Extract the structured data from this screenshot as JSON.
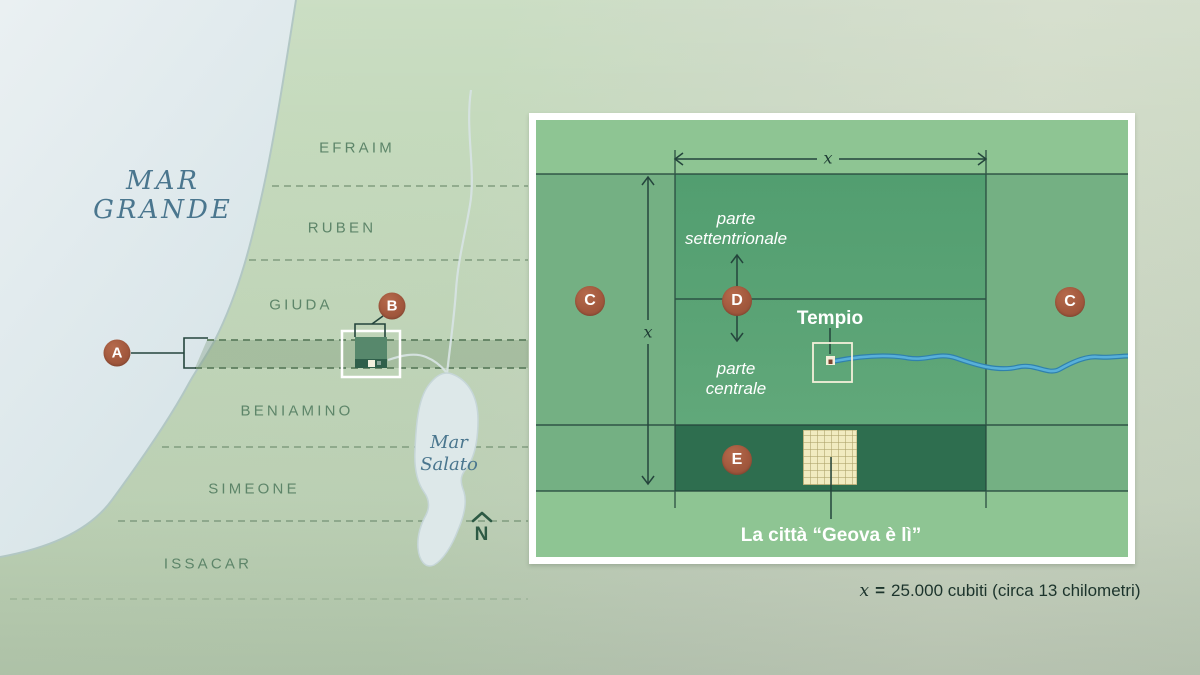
{
  "map": {
    "sea": {
      "line1": "MAR",
      "line2": "GRANDE"
    },
    "lake": {
      "line1": "Mar",
      "line2": "Salato"
    },
    "tribes": [
      {
        "label": "EFRAIM"
      },
      {
        "label": "RUBEN"
      },
      {
        "label": "GIUDA"
      },
      {
        "label": "BENIAMINO"
      },
      {
        "label": "SIMEONE"
      },
      {
        "label": "ISSACAR"
      }
    ],
    "compass_n": "N",
    "marker_a": "A",
    "marker_b": "B"
  },
  "inset": {
    "marker_c_left": "C",
    "marker_c_right": "C",
    "marker_d": "D",
    "marker_e": "E",
    "north_part": {
      "line1": "parte",
      "line2": "settentrionale"
    },
    "central_part": {
      "line1": "parte",
      "line2": "centrale"
    },
    "temple_label": "Tempio",
    "city_label": "La città “Geova è lì”",
    "dim_x_top": "x",
    "dim_x_left": "x"
  },
  "caption": {
    "x": "x",
    "equals": "=",
    "rest": "25.000 cubiti (circa 13 chilometri)"
  },
  "colors": {
    "marker": "#a2583d",
    "ink": "#24453c",
    "river": "#4aa6d6",
    "sea_text": "#4a768e",
    "tribe_text": "#5d8569",
    "city_band_green": "#2e6e4f",
    "holy_square_green": "#57a174",
    "city_square_cream": "#f1ebc0"
  }
}
